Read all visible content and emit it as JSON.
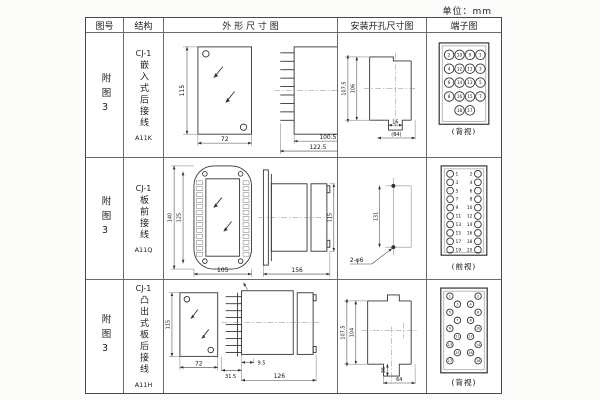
{
  "unit_label": "单位：mm",
  "header": {
    "fig": "图号",
    "structure": "结构",
    "outline": "外 形 尺 寸 图",
    "install": "安装开孔尺寸图",
    "terminal": "端子图"
  },
  "rows": [
    {
      "fig_no": "附图3",
      "model": "CJ-1",
      "structure": "嵌入式后接线",
      "code": "A11K",
      "outline": {
        "front_height": "115",
        "front_width": "72",
        "body_depth": "100.5",
        "total_depth": "122.5",
        "flange_depth": "35"
      },
      "install": {
        "height_outer": "107.5",
        "height_inner": "106",
        "notch_width": "16",
        "opening_width": "(64)"
      },
      "terminal": {
        "view_label": "(背视)",
        "layout": "grid",
        "numbers": [
          [
            "2",
            "10",
            "9",
            "1"
          ],
          [
            "4",
            "12",
            "11",
            "3"
          ],
          [
            "6",
            "14",
            "13",
            "5"
          ],
          [
            "8",
            "16",
            "15",
            "7"
          ],
          [
            "18",
            "17"
          ]
        ]
      }
    },
    {
      "fig_no": "附图3",
      "model": "CJ-1",
      "structure": "板前接线",
      "code": "A11Q",
      "outline": {
        "plate_height": "140",
        "inner_height": "125",
        "plate_width": "105",
        "total_depth": "156",
        "case_height": "115"
      },
      "install": {
        "hole_spacing": "131",
        "hole_spec": "2-φ6"
      },
      "terminal": {
        "view_label": "(前视)",
        "layout": "dual",
        "left": [
          "1",
          "3",
          "5",
          "7",
          "9",
          "11",
          "13",
          "15",
          "17",
          "19"
        ],
        "right": [
          "2",
          "4",
          "6",
          "8",
          "10",
          "12",
          "14",
          "16",
          "18",
          "20"
        ]
      }
    },
    {
      "fig_no": "附图3",
      "model": "CJ-1",
      "structure": "凸出式板后接线",
      "code": "A11H",
      "outline": {
        "front_height": "115",
        "front_width": "72",
        "pin_depth": "31.5",
        "step_depth": "9.5",
        "body_depth": "126"
      },
      "install": {
        "height_outer": "107.5",
        "height_inner": "104",
        "notch_height": "36",
        "opening_width": "64"
      },
      "terminal": {
        "view_label": "(背视)",
        "layout": "staggered",
        "left": [
          "1",
          "3",
          "5",
          "7",
          "9",
          "11",
          "13",
          "15",
          "17"
        ],
        "right": [
          "2",
          "4",
          "6",
          "8",
          "10",
          "12",
          "14",
          "16",
          "18"
        ]
      }
    }
  ]
}
